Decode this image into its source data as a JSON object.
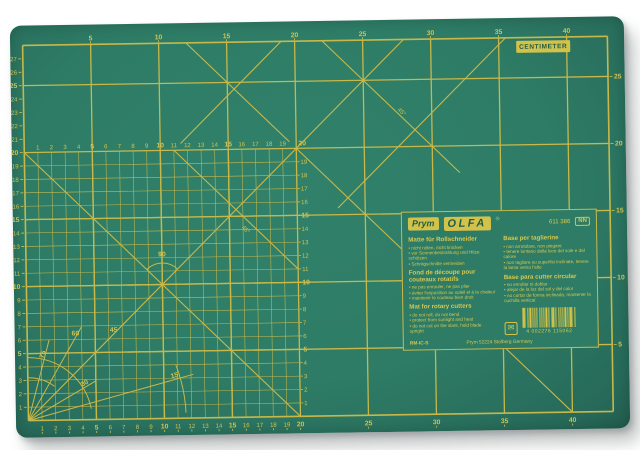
{
  "photo": {
    "background": "#ffffff"
  },
  "mat": {
    "colors": {
      "surface": "#2e7c66",
      "line": "#c8b84a",
      "text": "#d2c24e",
      "badge_bg": "#d2c24a",
      "badge_text": "#1f5c4a"
    },
    "centimeter_badge": "CENTIMETER",
    "geometry": {
      "origin_x": 12.5,
      "origin_y": 395,
      "px_per_cm_x": 13.6,
      "px_per_cm_y": 13.4,
      "cols": 43,
      "rows": 28,
      "fine_cols": 20,
      "fine_rows": 20
    },
    "rulers": {
      "top": [
        5,
        10,
        15,
        20,
        25,
        30,
        35,
        40
      ],
      "bottom_fine": [
        1,
        2,
        3,
        4,
        5,
        6,
        7,
        8,
        9,
        10,
        11,
        12,
        13,
        14,
        15,
        16,
        17,
        18,
        19
      ],
      "bottom_coarse": [
        20,
        25,
        30,
        35,
        40
      ],
      "left": [
        1,
        2,
        3,
        4,
        5,
        6,
        7,
        8,
        9,
        10,
        11,
        12,
        13,
        14,
        15,
        16,
        17,
        18,
        19,
        20,
        21,
        22,
        23,
        24,
        25,
        26,
        27
      ],
      "right": [
        5,
        10,
        15,
        20,
        25
      ],
      "fine_top": [
        1,
        2,
        3,
        4,
        5,
        6,
        7,
        8,
        9,
        10,
        11,
        12,
        13,
        14,
        15,
        16,
        17,
        18,
        19
      ],
      "fine_top_end": "20",
      "fine_right": [
        1,
        2,
        3,
        4,
        5,
        6,
        7,
        8,
        9,
        10,
        11,
        12,
        13,
        14,
        15,
        16,
        17,
        18,
        19
      ]
    },
    "diagonals": [
      {
        "x1": 0,
        "y1": 0,
        "x2": 28,
        "y2": 28
      },
      {
        "x1": 0,
        "y1": 20,
        "x2": 20,
        "y2": 0
      },
      {
        "x1": 22,
        "y1": 28,
        "x2": 32,
        "y2": 18
      },
      {
        "x1": 35.5,
        "y1": 28,
        "x2": 23,
        "y2": 15.5
      },
      {
        "x1": 20,
        "y1": 20,
        "x2": 40,
        "y2": 0
      },
      {
        "x1": 12,
        "y1": 28,
        "x2": 19.5,
        "y2": 20.5
      },
      {
        "x1": 11.5,
        "y1": 20.5,
        "x2": 19,
        "y2": 28
      },
      {
        "x1": 11,
        "y1": 20,
        "x2": 20,
        "y2": 11
      }
    ],
    "radials": [
      {
        "angle": 75,
        "r": 6.2,
        "label": "75",
        "label_r": 4.9,
        "label_rot": -75
      },
      {
        "angle": 60,
        "r": 8.0,
        "label": "60",
        "label_r": 7.1,
        "label_rot": 0
      },
      {
        "angle": 45,
        "r": 0,
        "label": "45",
        "label_r": 9.0,
        "label_rot": 0
      },
      {
        "angle": 30,
        "r": 5.8,
        "label": "30",
        "label_r": 4.9,
        "label_rot": -30
      },
      {
        "angle": 15,
        "r": 12.6,
        "label": "15",
        "label_r": 11.2,
        "label_rot": -15
      }
    ],
    "arcs": [
      {
        "r": 3.2,
        "a1": 52,
        "a2": 90
      },
      {
        "r": 4.7,
        "a1": 10,
        "a2": 90
      },
      {
        "r": 11.6,
        "a1": 2,
        "a2": 20
      }
    ],
    "angle_marks": [
      {
        "label": "90",
        "lx": 10,
        "ly": 12.1,
        "cx": 10,
        "cy": 10,
        "r": 1.6,
        "a1": 45,
        "a2": 135
      }
    ],
    "rotated_labels": [
      {
        "text": "45°",
        "x": 27.7,
        "y": 22.5,
        "rot": 45
      },
      {
        "text": "45°",
        "x": 16.1,
        "y": 13.9,
        "rot": 45
      }
    ]
  },
  "label_panel": {
    "brand_prym": "Prym",
    "brand_olfa": "OLFA",
    "olfa_reg": "®",
    "item_no": "611 386",
    "badge": "NN",
    "blocks": {
      "de": {
        "head": "Matte für Rollschneider",
        "bullets": [
          "nicht rollen, nicht knicken",
          "vor Sonnenbestrahlung und Hitze schützen",
          "Schrägschnitte vermeiden"
        ]
      },
      "fr": {
        "head": "Fond de découpe pour couteaux rotatifs",
        "bullets": [
          "ne pas enrouler, ne pas plier",
          "éviter l'exposition au soleil et à la chaleur",
          "maintenir le couteau bien droit"
        ]
      },
      "en": {
        "head": "Mat for rotary cutters",
        "bullets": [
          "do not roll, do not bend",
          "protect from sunlight and heat",
          "do not cut on the slant, hold blade upright"
        ]
      },
      "it": {
        "head": "Base per taglierine",
        "bullets": [
          "non arrotolare, non piegare",
          "tenere lontano dalla luce del sole e dal calore",
          "non tagliare su superfici inclinate, tenere la lama verso l'alto"
        ]
      },
      "es": {
        "head": "Base para cutter circular",
        "bullets": [
          "no enrollar ni doblar",
          "alejar de la luz del sol y del calor",
          "no cortar de forma inclinada, mantener la cuchilla vertical"
        ]
      }
    },
    "pictogram": {
      "name": "envelope-pictogram",
      "char": "✉"
    },
    "barcode": {
      "number": "4 002276 115062",
      "pattern": "211212211211221211212212112122121121221121122"
    },
    "product_code": "RM-IC-S",
    "address": "Prym 52224 Stolberg Germany"
  }
}
